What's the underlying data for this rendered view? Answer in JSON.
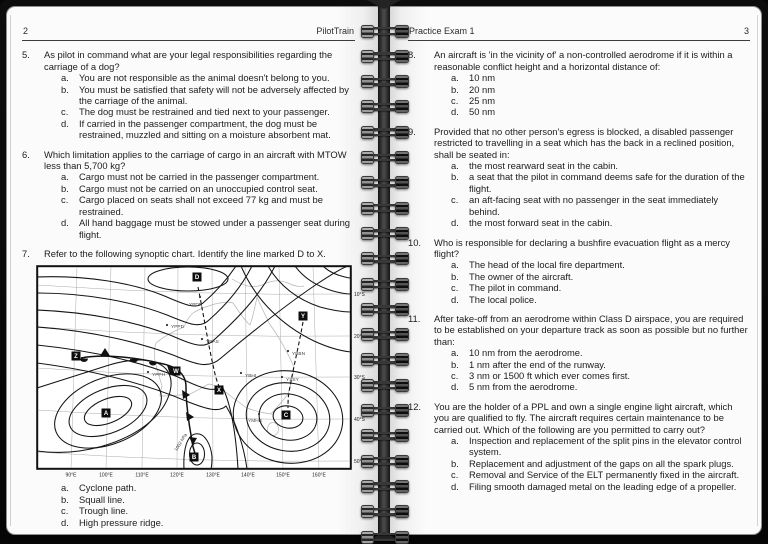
{
  "left_page": {
    "page_number": "2",
    "header_title": "PilotTrain",
    "questions": [
      {
        "number": "5.",
        "text": "As pilot in command what are your legal responsibilities regarding the carriage of a dog?",
        "options": [
          {
            "letter": "a.",
            "text": "You are not responsible as the animal doesn't belong to you."
          },
          {
            "letter": "b.",
            "text": "You must be satisfied that safety will not be adversely affected by the carriage of the animal."
          },
          {
            "letter": "c.",
            "text": "The dog must be restrained and tied next to your passenger."
          },
          {
            "letter": "d.",
            "text": "If carried in the passenger compartment, the dog must be restrained, muzzled and sitting on a moisture absorbent mat."
          }
        ]
      },
      {
        "number": "6.",
        "text": "Which limitation applies to the carriage of cargo in an aircraft with MTOW less than 5,700 kg?",
        "options": [
          {
            "letter": "a.",
            "text": "Cargo must not be carried in the passenger compartment."
          },
          {
            "letter": "b.",
            "text": "Cargo must not be carried on an unoccupied control seat."
          },
          {
            "letter": "c.",
            "text": "Cargo placed on seats shall not exceed 77 kg and must be restrained."
          },
          {
            "letter": "d.",
            "text": "All hand baggage must be stowed under a passenger seat during flight."
          }
        ]
      },
      {
        "number": "7.",
        "text": "Refer to the following synoptic chart. Identify the line marked D to X.",
        "chart": true,
        "options": [
          {
            "letter": "a.",
            "text": "Cyclone path."
          },
          {
            "letter": "b.",
            "text": "Squall line."
          },
          {
            "letter": "c.",
            "text": "Trough line."
          },
          {
            "letter": "d.",
            "text": "High pressure ridge."
          }
        ]
      }
    ]
  },
  "right_page": {
    "page_number": "3",
    "header_title": "Practice Exam 1",
    "questions": [
      {
        "number": "8.",
        "text": "An aircraft is 'in the vicinity of' a non-controlled aerodrome if it is within a reasonable conflict height and a horizontal distance of:",
        "options": [
          {
            "letter": "a.",
            "text": "10 nm"
          },
          {
            "letter": "b.",
            "text": "20 nm"
          },
          {
            "letter": "c.",
            "text": "25 nm"
          },
          {
            "letter": "d.",
            "text": "50 nm"
          }
        ]
      },
      {
        "number": "9.",
        "text": "Provided that no other person's egress is blocked, a disabled passenger restricted to travelling in a seat which has the back in a reclined position, shall be seated in:",
        "options": [
          {
            "letter": "a.",
            "text": "the most rearward seat in the cabin."
          },
          {
            "letter": "b.",
            "text": "a seat that the pilot in command deems safe for the duration of the flight."
          },
          {
            "letter": "c.",
            "text": "an aft-facing seat with no passenger in the seat immediately behind."
          },
          {
            "letter": "d.",
            "text": "the most forward seat in the cabin."
          }
        ]
      },
      {
        "number": "10.",
        "text": "Who is responsible for declaring a bushfire evacuation flight as a mercy flight?",
        "options": [
          {
            "letter": "a.",
            "text": "The head of the local fire department."
          },
          {
            "letter": "b.",
            "text": "The owner of the aircraft."
          },
          {
            "letter": "c.",
            "text": "The pilot in command."
          },
          {
            "letter": "d.",
            "text": "The local police."
          }
        ]
      },
      {
        "number": "11.",
        "text": "After take-off from an aerodrome within Class D airspace, you are required to be established on your departure track as soon as possible but no further than:",
        "options": [
          {
            "letter": "a.",
            "text": "10 nm from the aerodrome."
          },
          {
            "letter": "b.",
            "text": "1 nm after the end of the runway."
          },
          {
            "letter": "c.",
            "text": "3 nm or 1500 ft which ever comes first."
          },
          {
            "letter": "d.",
            "text": "5 nm from the aerodrome."
          }
        ]
      },
      {
        "number": "12.",
        "text": "You are the holder of a PPL and own a single engine light aircraft, which you are qualified to fly. The aircraft requires certain maintenance to be carried out. Which of the following are you permitted to carry out?",
        "options": [
          {
            "letter": "a.",
            "text": "Inspection and replacement of the split pins in the elevator control system."
          },
          {
            "letter": "b.",
            "text": "Replacement and adjustment of the gaps on all the spark plugs."
          },
          {
            "letter": "c.",
            "text": "Removal and Service of the ELT permanently fixed in the aircraft."
          },
          {
            "letter": "d.",
            "text": "Filing smooth damaged metal on the leading edge of a propeller."
          }
        ]
      }
    ]
  },
  "synoptic_chart": {
    "markers": [
      "A",
      "B",
      "C",
      "D",
      "W",
      "X",
      "Y",
      "Z"
    ],
    "stations": [
      "YPDN",
      "YPPD",
      "YBAS",
      "YBBN",
      "YPPH",
      "YBHI",
      "YSSY",
      "YMHB"
    ],
    "latitude_labels": [
      "10°S",
      "20°S",
      "30°S",
      "40°S",
      "50°S"
    ],
    "longitude_labels": [
      "90°E",
      "100°E",
      "110°E",
      "120°E",
      "130°E",
      "140°E",
      "150°E",
      "160°E"
    ],
    "isobar_label": "1002 hPa"
  }
}
